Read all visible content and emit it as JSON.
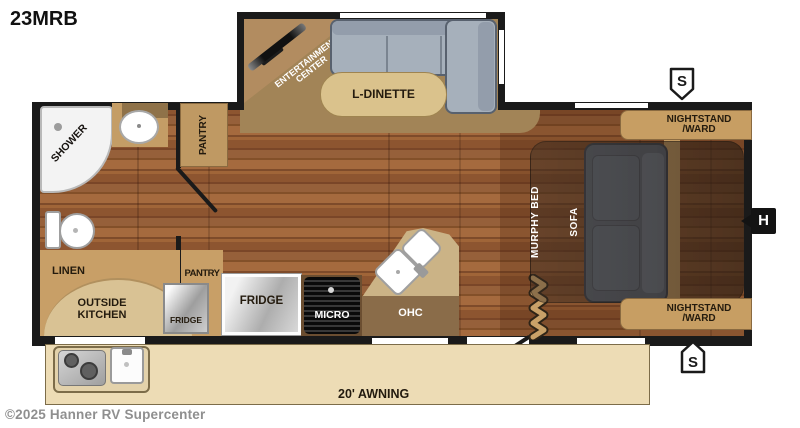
{
  "title": "23MRB",
  "watermark": "©2025 Hanner RV Supercenter",
  "floorplan": {
    "bathroom": {
      "shower": "SHOWER"
    },
    "pantry_upper": "PANTRY",
    "entertainment": {
      "line1": "ENTERTAINMENT",
      "line2": "CENTER"
    },
    "dinette": {
      "label": "L-DINETTE"
    },
    "bedroom": {
      "nightstand_line1": "NIGHTSTAND",
      "nightstand_line2": "/WARD",
      "murphy_bed": "MURPHY BED",
      "sofa": "SOFA"
    },
    "kitchen": {
      "linen": "LINEN",
      "outside_kitchen_line1": "OUTSIDE",
      "outside_kitchen_line2": "KITCHEN",
      "fridge_outside": "FRIDGE",
      "pantry_lower": "PANTRY",
      "fridge": "FRIDGE",
      "micro": "MICRO",
      "ohc": "OHC"
    },
    "awning": "20' AWNING",
    "markers": {
      "speaker": "S",
      "hookup": "H"
    }
  },
  "colors": {
    "walls": "#1a1a1a",
    "wood_floor": "#8d5530",
    "cabinet_tan": "#c89f67",
    "counter_tan": "#cbb386",
    "slideout_floor": "#a28457",
    "dinette_sofa_gray": "#a6b0bb",
    "bed_sofa_gray": "#5a6472",
    "awning_beige": "#eddcb5"
  }
}
